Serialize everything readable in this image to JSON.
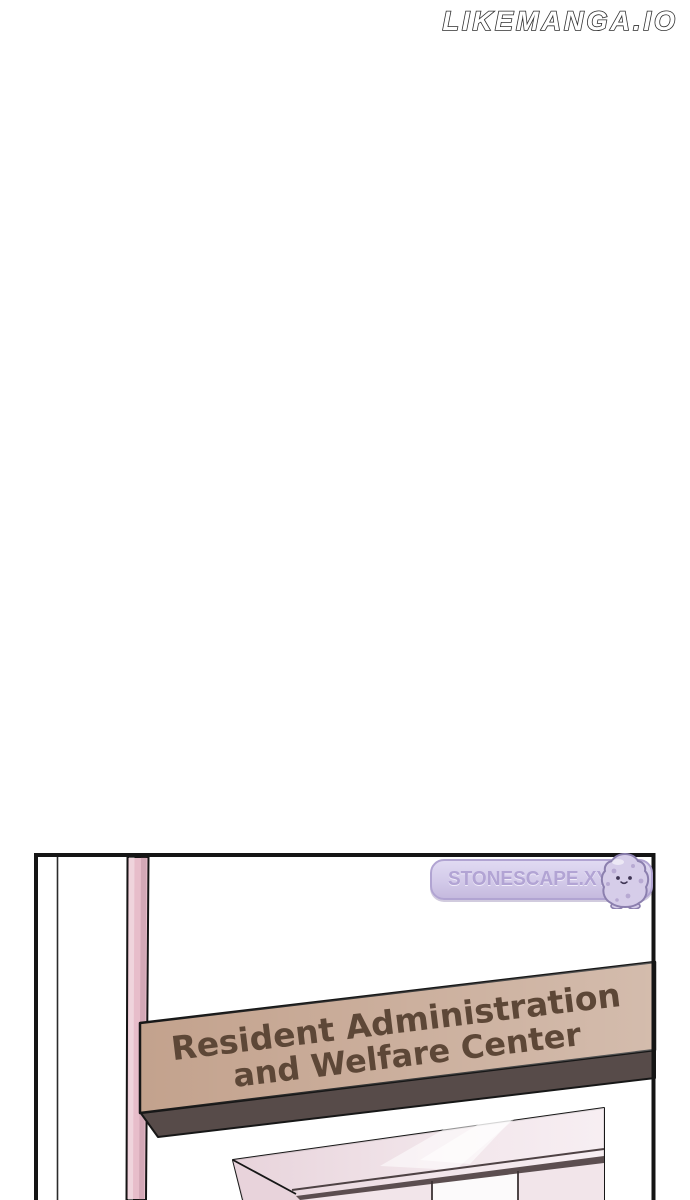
{
  "page": {
    "background_color": "#ffffff",
    "site_watermark": "LIKEMANGA.IO"
  },
  "panel": {
    "translator_watermark": {
      "text": "STONESCAPE.XYZ",
      "mascot_icon": "stone-mascot-icon"
    },
    "sign": {
      "line1": "Resident Administration",
      "line2": "and Welfare Center"
    },
    "colors": {
      "outline": "#171717",
      "pillar": "#e7bdca",
      "sign_face": "#c3a28d",
      "sign_edge": "#574b49",
      "sign_text": "#5d4737",
      "door_face": "#eedfe5",
      "door_side": "#e8d3db",
      "door_lower": "#f2e5ea",
      "door_band": "#5c4e50",
      "watermark_bg": "#d3cae9",
      "watermark_text": "#b2a4d4"
    }
  }
}
